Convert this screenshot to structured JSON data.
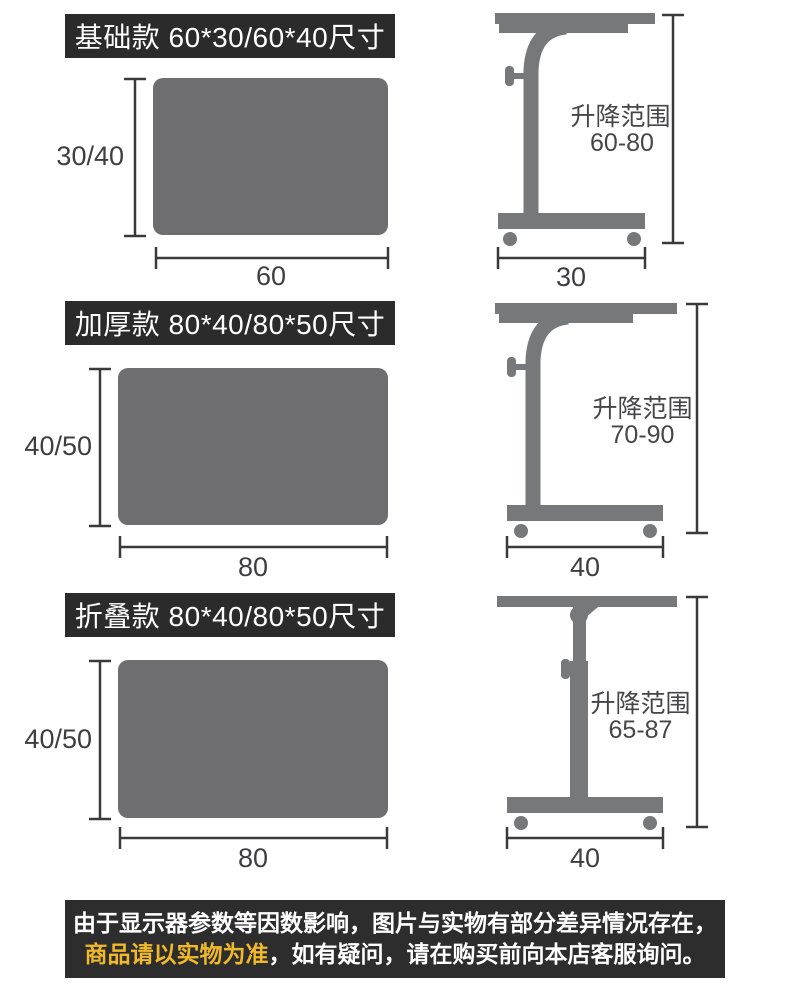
{
  "colors": {
    "banner_bg": "#2b2b2b",
    "footer_bg": "#2d2d2d",
    "panel_gray": "#6e6e70",
    "furniture_gray": "#77787a",
    "dim_line": "#3a3a3a",
    "label_text": "#3e3e40",
    "highlight_yellow": "#f0b929",
    "title_text": "#ffffff"
  },
  "sections": [
    {
      "id": "basic",
      "title": "基础款 60*30/60*40尺寸",
      "top_view": {
        "height_label": "30/40",
        "width_label": "60"
      },
      "side_view": {
        "range_line1": "升降范围",
        "range_line2": "60-80",
        "base_width_label": "30"
      }
    },
    {
      "id": "thickened",
      "title": "加厚款 80*40/80*50尺寸",
      "top_view": {
        "height_label": "40/50",
        "width_label": "80"
      },
      "side_view": {
        "range_line1": "升降范围",
        "range_line2": "70-90",
        "base_width_label": "40"
      }
    },
    {
      "id": "folding",
      "title": "折叠款 80*40/80*50尺寸",
      "top_view": {
        "height_label": "40/50",
        "width_label": "80"
      },
      "side_view": {
        "range_line1": "升降范围",
        "range_line2": "65-87",
        "base_width_label": "40"
      }
    }
  ],
  "footer": {
    "line1": "由于显示器参数等因数影响，图片与实物有部分差异情况存在，",
    "line2_highlight": "商品请以实物为准",
    "line2_rest": "，如有疑问，请在购买前向本店客服询问。"
  }
}
